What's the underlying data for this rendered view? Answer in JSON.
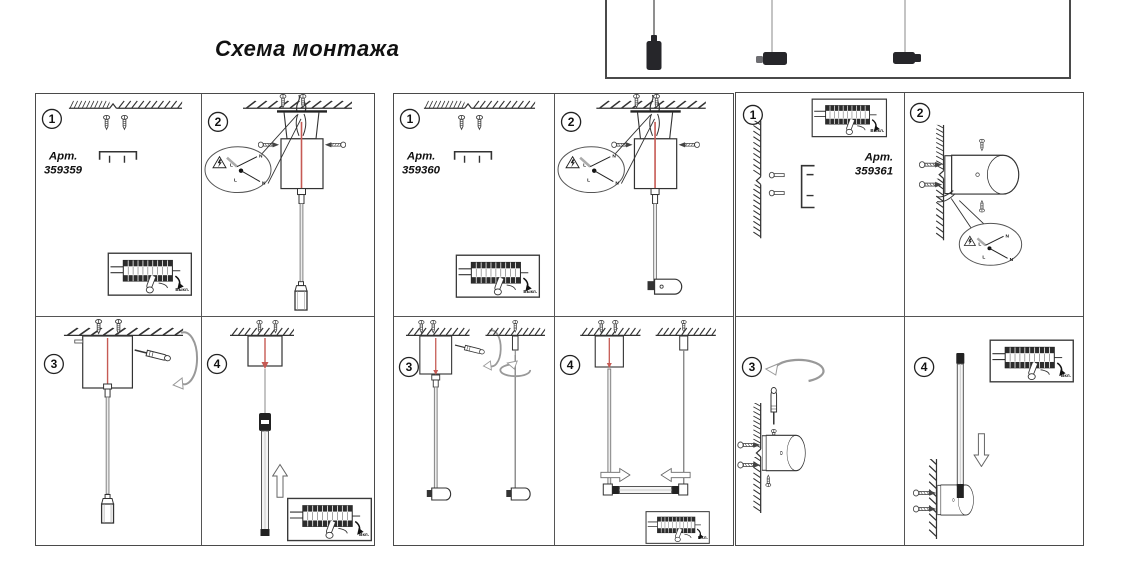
{
  "title": "Схема монтажа",
  "colors": {
    "line": "#333333",
    "cable_red": "#c65a54",
    "fixture_dark": "#26262a"
  },
  "product_preview": {
    "items": [
      "vertical-cylinder-pendant",
      "horizontal-cylinder-pendant",
      "horizontal-cylinder-pendant-connector"
    ]
  },
  "panels": [
    {
      "art_label": "Арт.",
      "art_number": "359359",
      "steps": [
        {
          "number": "1",
          "power_label": "Выкл."
        },
        {
          "number": "2",
          "wire_labels": [
            "N",
            "L",
            "L",
            "N"
          ]
        },
        {
          "number": "3"
        },
        {
          "number": "4",
          "power_label": "Вкл."
        }
      ]
    },
    {
      "art_label": "Арт.",
      "art_number": "359360",
      "steps": [
        {
          "number": "1",
          "power_label": "Выкл."
        },
        {
          "number": "2",
          "wire_labels": [
            "N",
            "L",
            "L",
            "N"
          ]
        },
        {
          "number": "3"
        },
        {
          "number": "4",
          "power_label": "Вкл."
        }
      ]
    },
    {
      "art_label": "Арт.",
      "art_number": "359361",
      "steps": [
        {
          "number": "1",
          "power_label": "Выкл."
        },
        {
          "number": "2",
          "wire_labels": [
            "N",
            "L",
            "L",
            "N"
          ]
        },
        {
          "number": "3"
        },
        {
          "number": "4",
          "power_label": "Вкл."
        }
      ]
    }
  ]
}
